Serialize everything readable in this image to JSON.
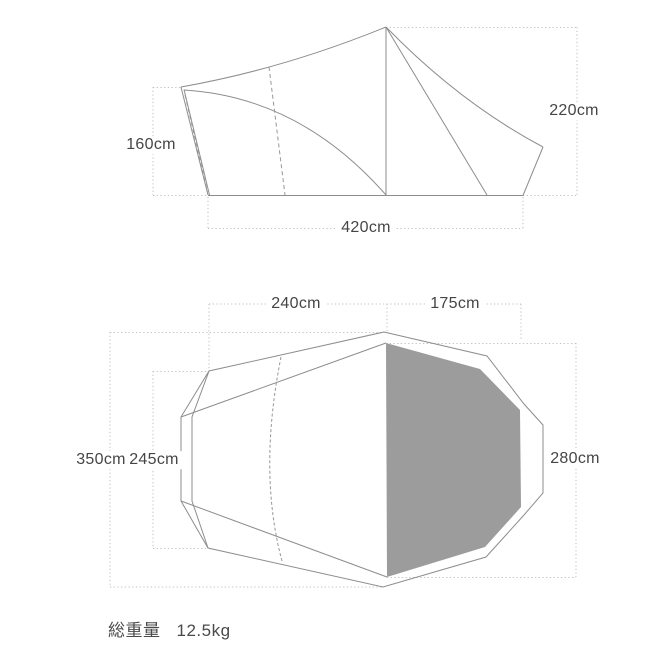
{
  "side_view": {
    "height_left": "160cm",
    "height_right": "220cm",
    "width": "420cm"
  },
  "top_view": {
    "width_left": "240cm",
    "width_right": "175cm",
    "length_outer": "350cm",
    "length_inner": "245cm",
    "height_right": "280cm"
  },
  "footer": {
    "weight_label": "総重量",
    "weight_value": "12.5kg"
  },
  "colors": {
    "line": "#8d8d8d",
    "dashed": "#979797",
    "dotted": "#c2c2c2",
    "panel": "#9c9c9c",
    "text": "#454545"
  }
}
